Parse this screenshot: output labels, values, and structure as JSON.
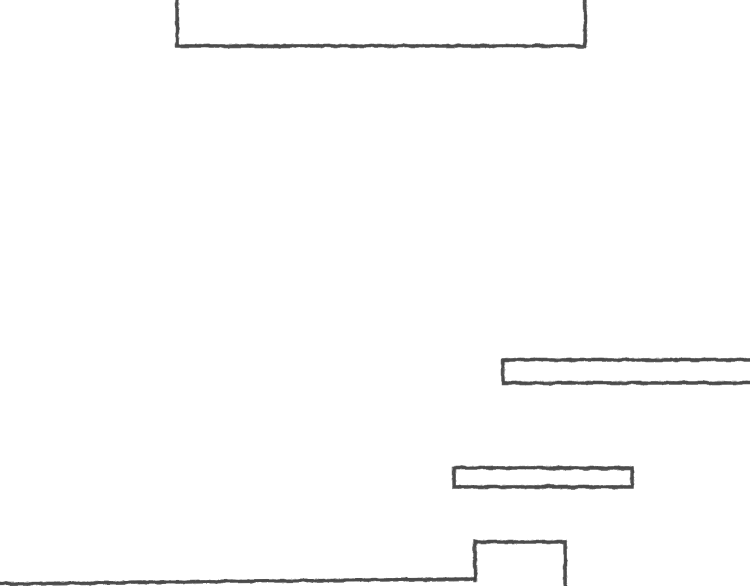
{
  "canvas": {
    "width": 750,
    "height": 586,
    "background_color": "#ffffff",
    "stroke_color": "#3d3d3d",
    "stroke_width": 3.4,
    "style": "hand-drawn-pencil-sketch"
  },
  "shapes": [
    {
      "name": "top-structure-outline",
      "description": "large rectangle cropped by the top edge of the image",
      "closed": false,
      "points": [
        [
          177,
          -8
        ],
        [
          177,
          46
        ],
        [
          585,
          46
        ],
        [
          585,
          -8
        ]
      ]
    },
    {
      "name": "right-platform-outline",
      "description": "long thin rectangle cropped by the right edge of the image",
      "closed": false,
      "points": [
        [
          756,
          360
        ],
        [
          503,
          360
        ],
        [
          503,
          383
        ],
        [
          756,
          383
        ]
      ]
    },
    {
      "name": "middle-platform-outline",
      "description": "small thin closed rectangle",
      "closed": true,
      "points": [
        [
          454,
          468
        ],
        [
          632,
          468
        ],
        [
          632,
          487
        ],
        [
          454,
          487
        ]
      ]
    },
    {
      "name": "ground-line",
      "description": "floor line from the left edge, sloping up very slightly to the right",
      "closed": false,
      "points": [
        [
          -4,
          584
        ],
        [
          474,
          579
        ]
      ]
    },
    {
      "name": "pedestal-outline",
      "description": "small block standing on the ground, right side cropped by the bottom edge",
      "closed": false,
      "points": [
        [
          475,
          581
        ],
        [
          475,
          542
        ],
        [
          565,
          542
        ],
        [
          565,
          592
        ]
      ]
    }
  ]
}
